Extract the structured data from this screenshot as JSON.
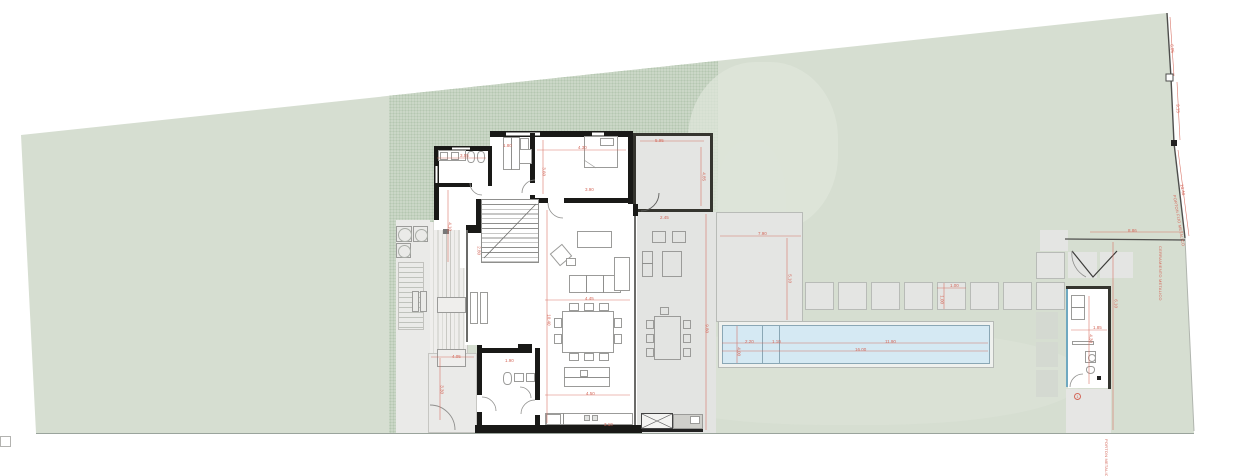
{
  "drawing": {
    "type": "architectural-site-plan",
    "description": "single-storey house plan on a trapezoidal lot with side deck, covered terrace, paved patio, stepping stones, linear pool and pool-house annex"
  },
  "colors": {
    "lawn": "#d6ded1",
    "hatch_base": "#cbd7c7",
    "hatch_dot": "#b5c7b1",
    "paving": "#e4e5e3",
    "paving_border": "#b8bbb7",
    "terrace": "#e3e4e2",
    "court": "#eaeae8",
    "deck": "#efeeec",
    "pool_water": "#d5e9f3",
    "pool_edge": "#8aa7b5",
    "pool_deck": "#eff1ee",
    "wall": "#191917",
    "furniture_line": "#9b9b99",
    "dimension_red": "#d4685a",
    "boundary": "#4e4e4c"
  },
  "annotations": {
    "dims": [
      {
        "x": 460,
        "y": 154,
        "t": "3.55"
      },
      {
        "x": 503,
        "y": 144,
        "t": "1.80"
      },
      {
        "x": 578,
        "y": 146,
        "t": "4.30"
      },
      {
        "x": 655,
        "y": 139,
        "t": "5.95"
      },
      {
        "x": 703,
        "y": 170,
        "r": 90,
        "t": "4.85"
      },
      {
        "x": 543,
        "y": 165,
        "r": 90,
        "t": "3.60"
      },
      {
        "x": 585,
        "y": 188,
        "t": "3.90"
      },
      {
        "x": 449,
        "y": 220,
        "r": 90,
        "t": "4.10"
      },
      {
        "x": 548,
        "y": 312,
        "r": 90,
        "t": "10.40"
      },
      {
        "x": 585,
        "y": 297,
        "t": "4.45"
      },
      {
        "x": 586,
        "y": 392,
        "t": "4.50"
      },
      {
        "x": 505,
        "y": 359,
        "t": "1.90"
      },
      {
        "x": 441,
        "y": 383,
        "r": 90,
        "t": "3.30"
      },
      {
        "x": 452,
        "y": 355,
        "t": "4.05"
      },
      {
        "x": 706,
        "y": 322,
        "r": 90,
        "t": "9.80"
      },
      {
        "x": 758,
        "y": 232,
        "t": "7.90"
      },
      {
        "x": 789,
        "y": 272,
        "r": 90,
        "t": "5.10"
      },
      {
        "x": 745,
        "y": 340,
        "t": "2.20"
      },
      {
        "x": 772,
        "y": 340,
        "t": "1.10"
      },
      {
        "x": 885,
        "y": 340,
        "t": "11.90"
      },
      {
        "x": 855,
        "y": 348,
        "t": "16.00"
      },
      {
        "x": 738,
        "y": 345,
        "r": 90,
        "t": "4.00"
      },
      {
        "x": 950,
        "y": 284,
        "t": "1.00"
      },
      {
        "x": 941,
        "y": 293,
        "r": 90,
        "t": "1.00"
      },
      {
        "x": 1128,
        "y": 229,
        "t": "8.86"
      },
      {
        "x": 1171,
        "y": 42,
        "r": 84,
        "t": "6.05"
      },
      {
        "x": 1177,
        "y": 102,
        "r": 87,
        "t": "9.15"
      },
      {
        "x": 1181,
        "y": 182,
        "r": 80,
        "t": "10.40"
      },
      {
        "x": 1090,
        "y": 332,
        "r": 90,
        "t": "4.30"
      },
      {
        "x": 1093,
        "y": 326,
        "t": "1.85"
      },
      {
        "x": 660,
        "y": 216,
        "t": "2.45"
      },
      {
        "x": 1115,
        "y": 297,
        "r": 90,
        "t": "6.10"
      },
      {
        "x": 478,
        "y": 244,
        "r": 90,
        "t": "2.80"
      },
      {
        "x": 604,
        "y": 423,
        "t": "3.10"
      }
    ],
    "notes": [
      {
        "x": 1160,
        "y": 244,
        "r": 90,
        "t": "CERRAMIENTO METALICO"
      },
      {
        "x": 1174,
        "y": 193,
        "r": 80,
        "t": "PORTON FIJO METALICO"
      },
      {
        "x": 1106,
        "y": 437,
        "r": 90,
        "t": "PORTON METALICO"
      }
    ],
    "symbols": [
      {
        "x": 1074,
        "y": 393,
        "t": "1"
      }
    ]
  }
}
